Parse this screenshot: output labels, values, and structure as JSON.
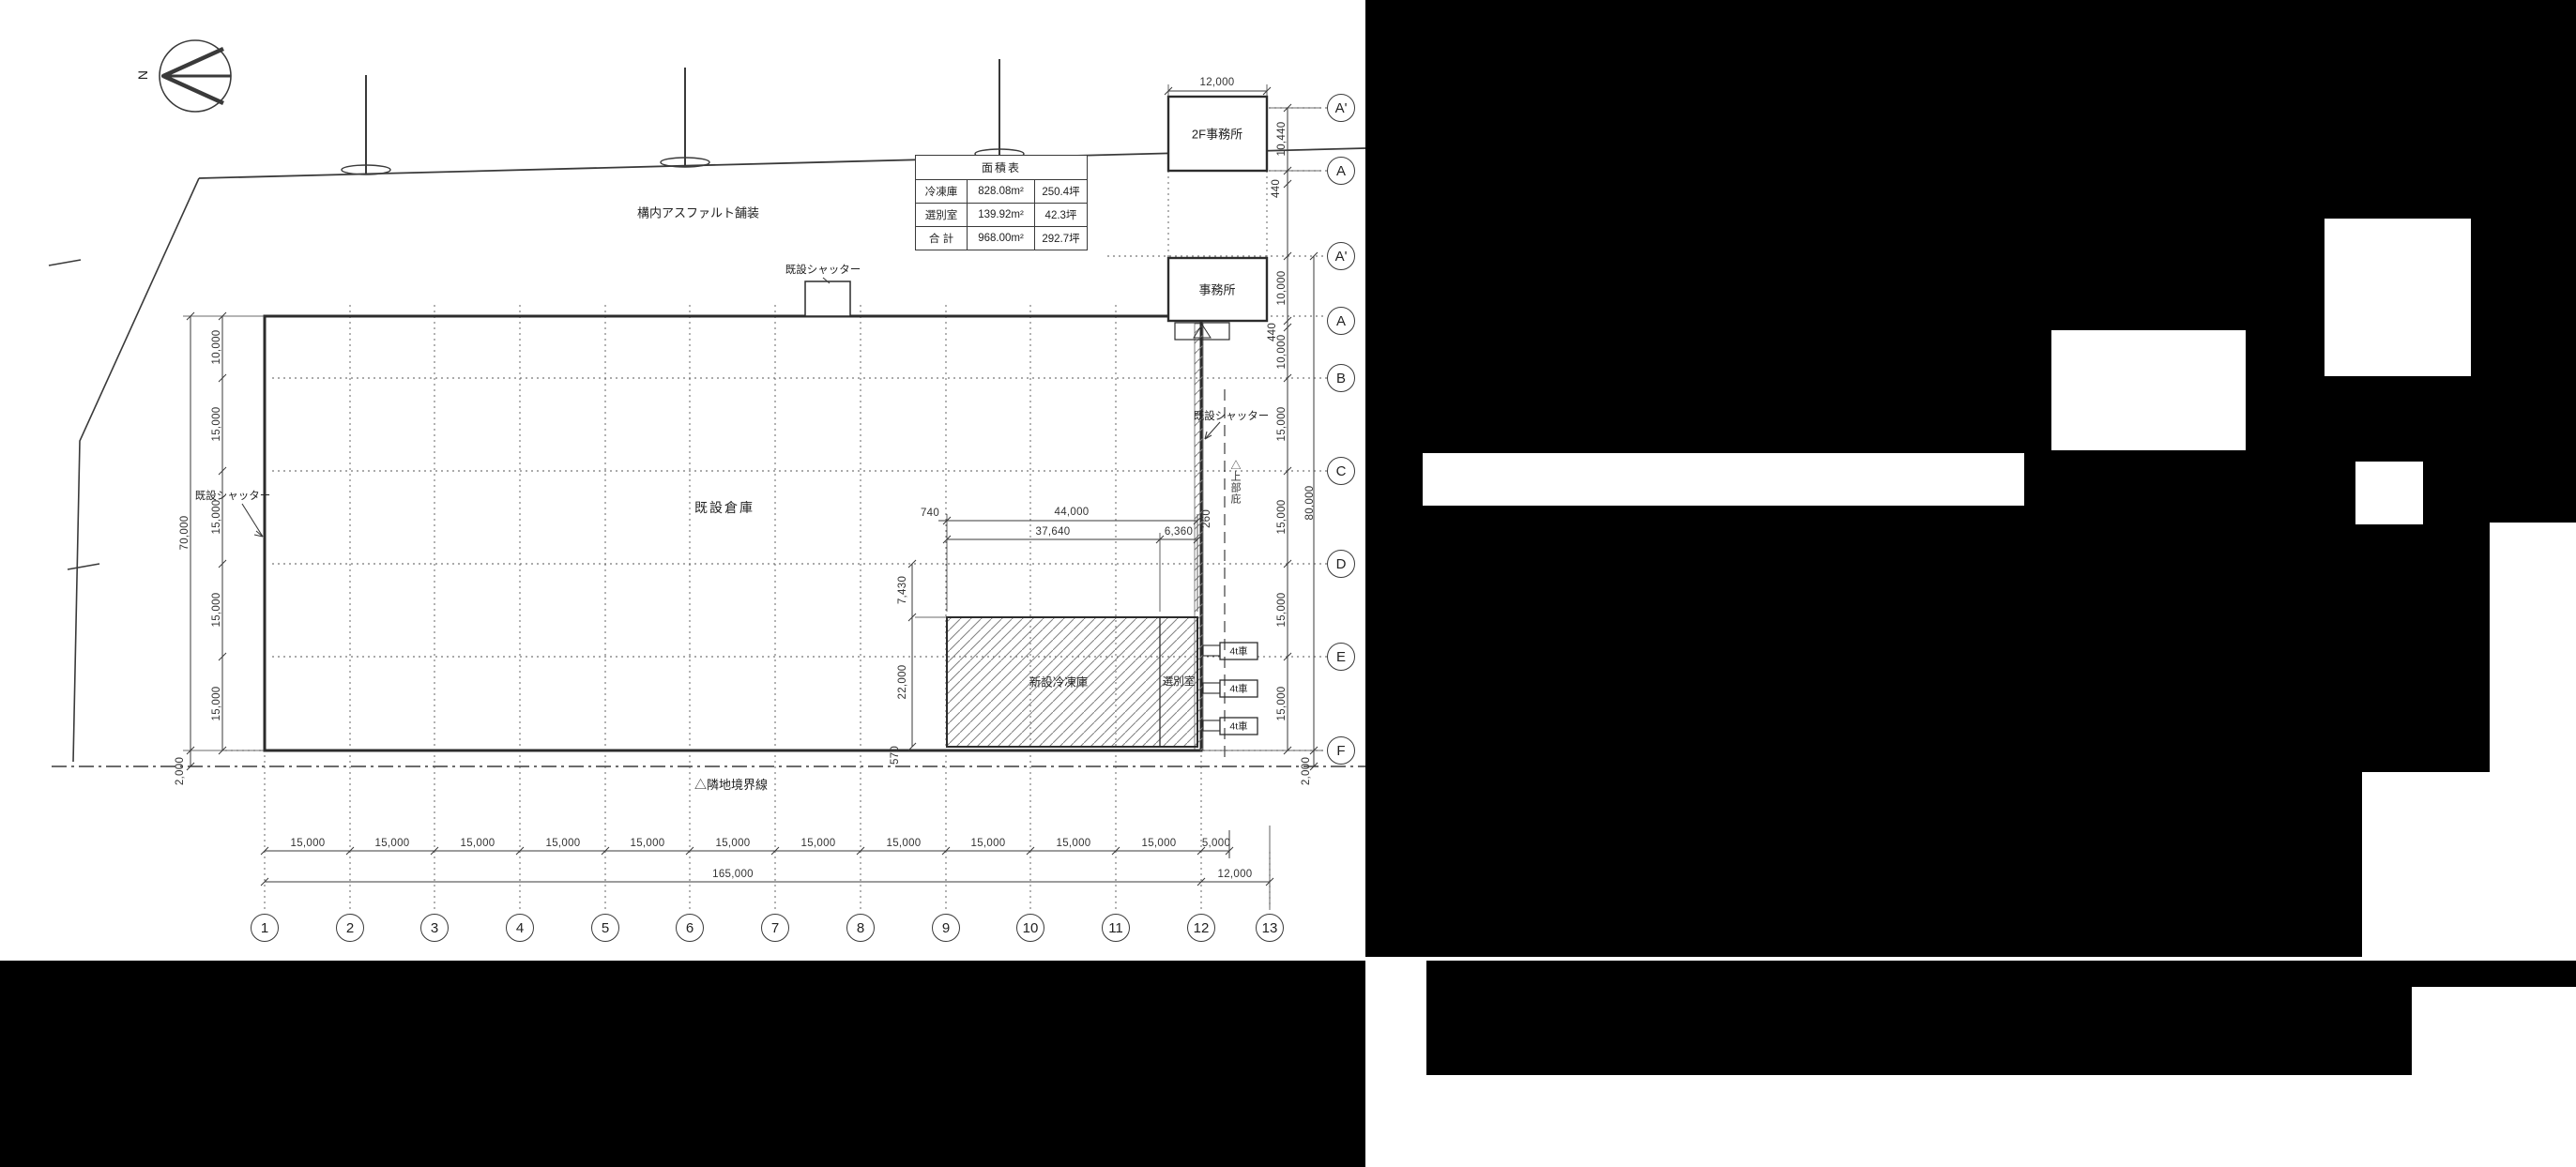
{
  "compass": {
    "label": "N"
  },
  "area_table": {
    "title": "面積表",
    "rows": [
      {
        "name": "冷凍庫",
        "area": "828.08m²",
        "tsubo": "250.4坪"
      },
      {
        "name": "選別室",
        "area": "139.92m²",
        "tsubo": "42.3坪"
      },
      {
        "name": "合 計",
        "area": "968.00m²",
        "tsubo": "292.7坪"
      }
    ]
  },
  "labels": {
    "asphalt": "構内アスファルト舗装",
    "existing_warehouse": "既設倉庫",
    "new_freezer": "新設冷凍庫",
    "sorting_room": "選別室",
    "existing_shutter": "既設シャッター",
    "boundary_line": "△隣地境界線",
    "canopy": "△上部庇",
    "office_2f": "2F事務所",
    "office": "事務所",
    "truck_4t": "4t車"
  },
  "grid": {
    "cols": [
      "1",
      "2",
      "3",
      "4",
      "5",
      "6",
      "7",
      "8",
      "9",
      "10",
      "11",
      "12",
      "13"
    ],
    "rows": [
      "A'",
      "A",
      "A'",
      "A",
      "B",
      "C",
      "D",
      "E",
      "F"
    ]
  },
  "dims": {
    "d15000": "15,000",
    "d10000": "10,000",
    "d12000": "12,000",
    "d5000": "5,000",
    "d165000": "165,000",
    "d70000": "70,000",
    "d80000": "80,000",
    "d2000": "2,000",
    "d10440": "10,440",
    "d440": "440",
    "d44000": "44,000",
    "d37640": "37,640",
    "d6360": "6,360",
    "d740": "740",
    "d260": "260",
    "d7430": "7,430",
    "d22000": "22,000",
    "d570": "570"
  }
}
